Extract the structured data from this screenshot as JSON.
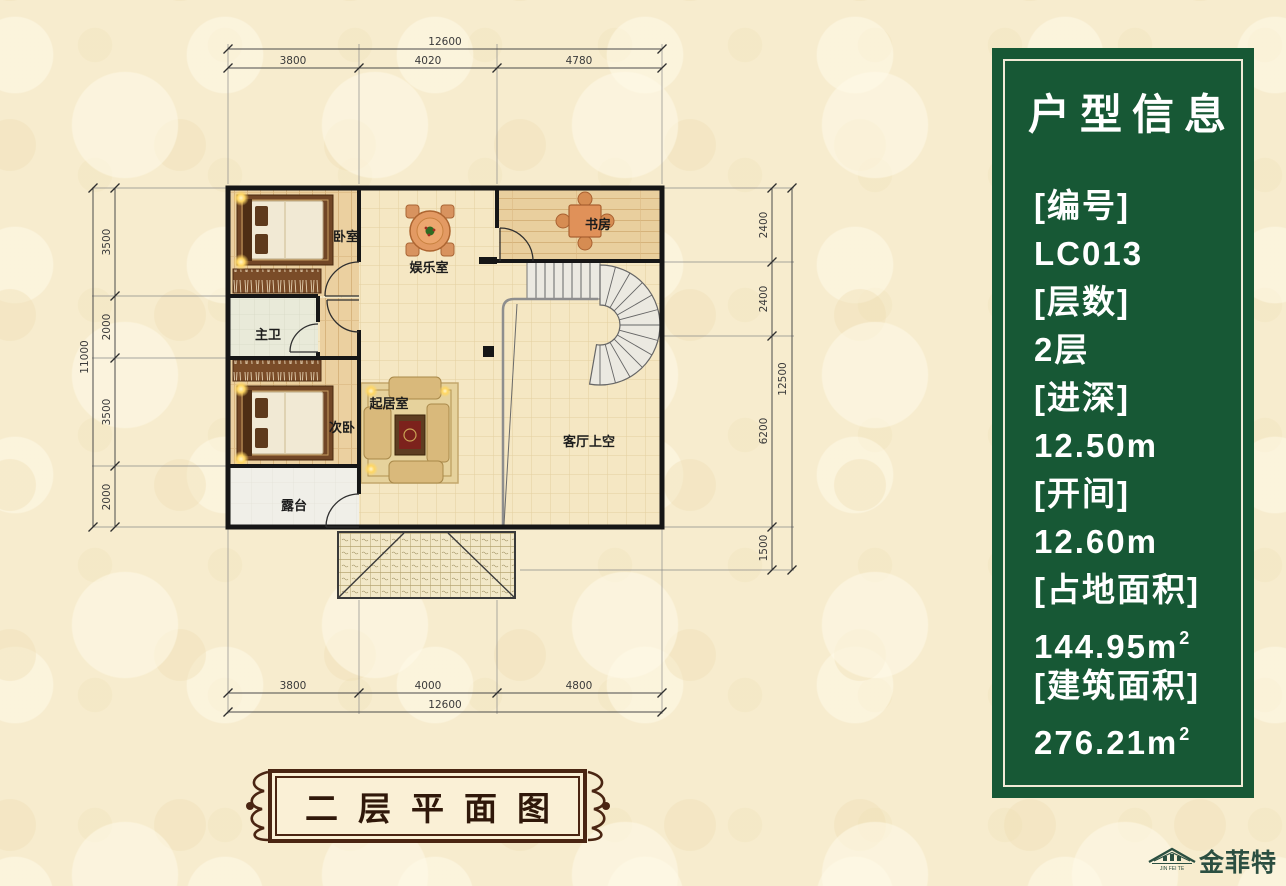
{
  "plan": {
    "rooms": {
      "bedroom1": "卧室",
      "bath": "主卫",
      "bedroom2": "次卧",
      "terrace": "露台",
      "recreation": "娱乐室",
      "study": "书房",
      "sitting": "起居室",
      "living_void": "客厅上空"
    },
    "dims": {
      "top": {
        "overall": "12600",
        "segs": [
          "3800",
          "4020",
          "4780"
        ]
      },
      "bottom": {
        "overall": "12600",
        "segs": [
          "3800",
          "4000",
          "4800"
        ]
      },
      "left": {
        "overall": "11000",
        "segs": [
          "3500",
          "2000",
          "3500",
          "2000"
        ]
      },
      "right": {
        "overall": "12500",
        "segs": [
          "2400",
          "2400",
          "6200",
          "1500"
        ]
      }
    }
  },
  "info_panel": {
    "title": "户型信息",
    "accent_color": "#175835",
    "lines": [
      {
        "text": "[编号]"
      },
      {
        "text": "LC013"
      },
      {
        "text": "[层数]"
      },
      {
        "text": "2层"
      },
      {
        "text": "[进深]"
      },
      {
        "text": "12.50m"
      },
      {
        "text": "[开间]"
      },
      {
        "text": "12.60m"
      },
      {
        "text": "[占地面积]"
      },
      {
        "text": "144.95m",
        "sup": "2"
      },
      {
        "text": "[建筑面积]"
      },
      {
        "text": "276.21m",
        "sup": "2"
      }
    ]
  },
  "caption": {
    "title": "二层平面图"
  },
  "logo": {
    "name": "金菲特",
    "sub": "JIN FEI TE"
  }
}
